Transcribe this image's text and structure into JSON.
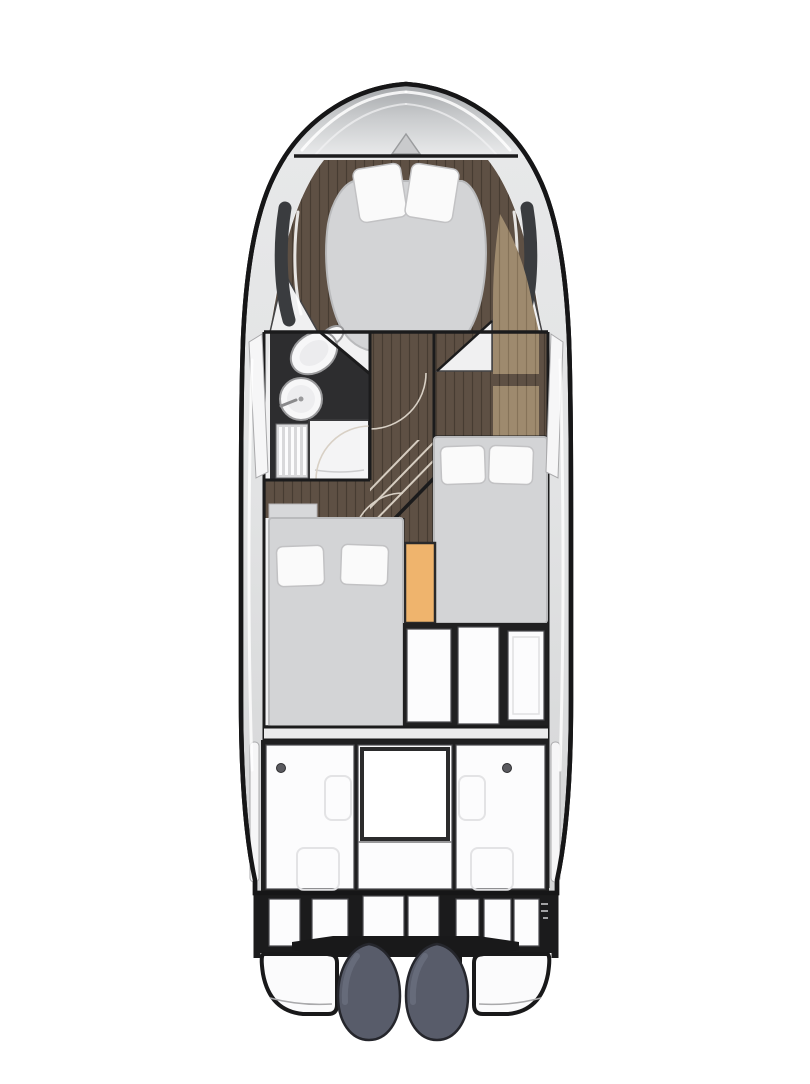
{
  "canvas": {
    "width": 810,
    "height": 1080,
    "background": "#ffffff"
  },
  "palette": {
    "background": "#ffffff",
    "hull_line": "#161617",
    "interior_base": "#f1f1f2",
    "wood_dark": "#5e5044",
    "wood_light": "#9e8a6e",
    "mattress": "#d3d4d6",
    "mattress_edge": "#b9babc",
    "pillow": "#fafafa",
    "pillow_edge": "#c2c2c4",
    "bathroom_floor": "#2d2d2f",
    "fixture": "#f7f7f8",
    "fixture_edge": "#9a9a9c",
    "wardrobe_orange": "#efb46d",
    "deck_white": "#fcfcfd",
    "deck_dark": "#202021",
    "panel_edge": "#1b1b1c",
    "hull_window": "#3a3c3f",
    "engine_body": "#585c6a",
    "engine_highlight": "#6e7383"
  },
  "plan": {
    "view": "top-down",
    "subject": "motor-yacht-interior-floor-plan",
    "zones": {
      "foredeck": {
        "features": [
          "bow-chevron",
          "windshield-highlights"
        ]
      },
      "bow_cabin": {
        "berths": 1,
        "pillows": 2,
        "floor": "dark-wood",
        "hull_windows": 2
      },
      "bathroom": {
        "fixtures": [
          "toilet",
          "round-washbasin",
          "shower-grate",
          "vanity-counter"
        ]
      },
      "companionway": {
        "features": [
          "diagonal-stairs",
          "door-arcs"
        ],
        "floor": "dark-wood"
      },
      "side_cabinetry": {
        "material": "light-wood",
        "blocks": 2
      },
      "guest_bed_right": {
        "berths": 1,
        "pillows": 2
      },
      "mid_cabin_bed": {
        "berths": 1,
        "pillows": 2
      },
      "wardrobe": {
        "count": 1
      },
      "galley_units": {
        "panels": 3
      },
      "cockpit": {
        "table": 1,
        "benches": 3,
        "hatches": 4,
        "deck_dots": 2
      },
      "transom": {
        "seat_panels": 7
      },
      "stern": {
        "swim_platforms": 2,
        "outboard_engines": 2,
        "engine_bracket": 1
      }
    }
  }
}
